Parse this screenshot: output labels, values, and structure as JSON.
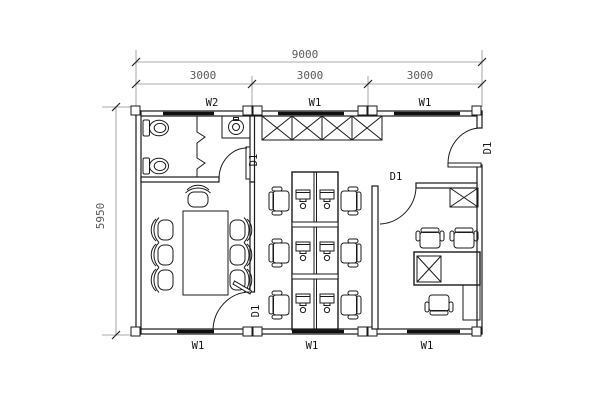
{
  "plan": {
    "dimensions": {
      "total_width": "9000",
      "bays": [
        "3000",
        "3000",
        "3000"
      ],
      "total_height": "5950"
    },
    "windows": {
      "top": [
        "W2",
        "W1",
        "W1"
      ],
      "bottom": [
        "W1",
        "W1",
        "W1"
      ]
    },
    "doors": {
      "toilet_door": "D1",
      "meeting_room_door": "D1",
      "office_door": "D1",
      "entrance_door": "D1"
    },
    "colors": {
      "background": "#ffffff",
      "wall_line": "#1a1a1a",
      "dimension_text": "#5a5a5a",
      "label_text": "#141414"
    }
  }
}
